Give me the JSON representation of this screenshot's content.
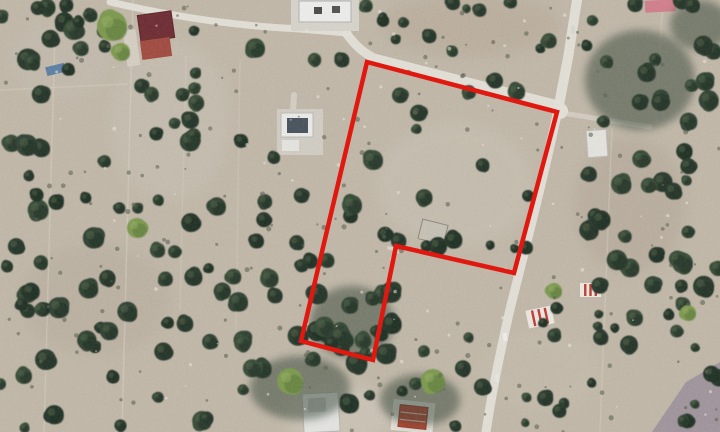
{
  "map": {
    "description": "Satellite aerial view of rural olive-grove parcels with a red land-parcel boundary overlay",
    "canvas": {
      "width": 720,
      "height": 432
    },
    "palette": {
      "soil_base": "#c4bbac",
      "soil_edge": "#b7ad9e",
      "road": "#e9e6de",
      "track": "#ded8ca",
      "tree_greens": [
        "#2e4130",
        "#27382a",
        "#364a36",
        "#203126"
      ],
      "tree_shadow": "#1c2a20",
      "tree_highlight": "#4d6344",
      "bright_green": "#7d9b4e",
      "bright_green_shade": "#5a7839",
      "purple_field": "#9e939d",
      "overlay_red": "#e0180f"
    },
    "overlay": {
      "label": "parcel-boundary-polygon",
      "color": "#e0180f",
      "stroke_width": 4.5,
      "points": [
        [
          367,
          62
        ],
        [
          557,
          112
        ],
        [
          514,
          273
        ],
        [
          396,
          246
        ],
        [
          373,
          360
        ],
        [
          301,
          341
        ],
        [
          329,
          222
        ]
      ]
    },
    "seed": 20240613,
    "patches": [
      {
        "cx": 455,
        "cy": 185,
        "rx": 78,
        "ry": 62,
        "fill": "#cdc6b8",
        "op": 0.55
      },
      {
        "cx": 340,
        "cy": 415,
        "rx": 55,
        "ry": 30,
        "fill": "#d8d2c5",
        "op": 0.5
      },
      {
        "cx": 630,
        "cy": 205,
        "rx": 55,
        "ry": 68,
        "fill": "#b4a698",
        "op": 0.45
      },
      {
        "cx": 95,
        "cy": 300,
        "rx": 75,
        "ry": 55,
        "fill": "#b6ab9c",
        "op": 0.35
      },
      {
        "cx": 170,
        "cy": 120,
        "rx": 60,
        "ry": 80,
        "fill": "#cfc8bb",
        "op": 0.4
      },
      {
        "cx": 540,
        "cy": 370,
        "rx": 60,
        "ry": 40,
        "fill": "#cbc2b2",
        "op": 0.4
      },
      {
        "cx": 60,
        "cy": 60,
        "rx": 50,
        "ry": 40,
        "fill": "#c9c2b6",
        "op": 0.4
      },
      {
        "cx": 470,
        "cy": 25,
        "rx": 90,
        "ry": 32,
        "fill": "#b9ab9a",
        "op": 0.5
      }
    ],
    "purple_field_points": [
      [
        652,
        432
      ],
      [
        686,
        382
      ],
      [
        720,
        362
      ],
      [
        720,
        432
      ]
    ],
    "field_lines": [
      {
        "x1": 55,
        "y1": 32,
        "x2": 44,
        "y2": 432,
        "op": 0.45
      },
      {
        "x1": 133,
        "y1": 0,
        "x2": 122,
        "y2": 432,
        "op": 0.5
      },
      {
        "x1": 186,
        "y1": 55,
        "x2": 180,
        "y2": 310,
        "op": 0.3
      },
      {
        "x1": 0,
        "y1": 90,
        "x2": 128,
        "y2": 84,
        "op": 0.4
      },
      {
        "x1": 612,
        "y1": 128,
        "x2": 600,
        "y2": 432,
        "op": 0.4
      },
      {
        "x1": 663,
        "y1": 0,
        "x2": 656,
        "y2": 115,
        "op": 0.35
      },
      {
        "x1": 240,
        "y1": 60,
        "x2": 236,
        "y2": 330,
        "op": 0.3
      }
    ],
    "roads": [
      {
        "name": "top-road",
        "d": "M110,2 C170,16 235,26 300,29 L348,33",
        "w": 7,
        "op": 0.95
      },
      {
        "name": "parcel-north-road",
        "d": "M346,33 C355,45 362,52 374,58 L558,105",
        "w": 9,
        "op": 0.95
      },
      {
        "name": "main-road-north",
        "d": "M577,0 L568,58 L558,110",
        "w": 10,
        "op": 0.95
      },
      {
        "name": "main-road-south",
        "d": "M558,110 C542,185 522,262 511,305 C501,348 492,392 486,432",
        "w": 9,
        "op": 0.95
      },
      {
        "name": "east-track",
        "d": "M562,113 L650,127",
        "w": 5,
        "op": 0.5
      },
      {
        "name": "driveway",
        "d": "M294,95 L291,142",
        "w": 6,
        "op": 0.55
      }
    ],
    "vehicles": [
      {
        "x": 503,
        "y": 333,
        "w": 4,
        "h": 8,
        "rot": -8,
        "fill": "#f3f3f0"
      },
      {
        "x": 495,
        "y": 374,
        "w": 4,
        "h": 8,
        "rot": -6,
        "fill": "#eaeae6"
      },
      {
        "x": 571,
        "y": 26,
        "w": 4,
        "h": 8,
        "rot": -5,
        "fill": "#dcdcd8"
      }
    ],
    "buildings": [
      {
        "name": "farmhouse-courtyard",
        "x": 125,
        "y": 30,
        "w": 13,
        "h": 36,
        "rot": -8,
        "fill": "#d9d3c7"
      },
      {
        "name": "farmhouse-dark-red-roof",
        "x": 139,
        "y": 13,
        "w": 34,
        "h": 27,
        "rot": -8,
        "fill": "#6e2a31",
        "stroke": "#5a2027"
      },
      {
        "name": "farmhouse-red-roof-wing",
        "x": 141,
        "y": 39,
        "w": 30,
        "h": 19,
        "rot": -8,
        "fill": "#a34a3f"
      },
      {
        "name": "warehouse-pad",
        "x": 291,
        "y": 0,
        "w": 68,
        "h": 31,
        "rot": 0,
        "fill": "#dbd8d0"
      },
      {
        "name": "warehouse",
        "x": 299,
        "y": 1,
        "w": 52,
        "h": 21,
        "rot": 0,
        "fill": "#f1f2f2",
        "stroke": "#b5b5b3"
      },
      {
        "name": "warehouse-roof-unit-1",
        "x": 314,
        "y": 7,
        "w": 8,
        "h": 7,
        "rot": 0,
        "fill": "#4a4a48"
      },
      {
        "name": "warehouse-roof-unit-2",
        "x": 332,
        "y": 6,
        "w": 8,
        "h": 7,
        "rot": 0,
        "fill": "#54524e"
      },
      {
        "name": "poolhouse-pad",
        "x": 277,
        "y": 109,
        "w": 46,
        "h": 46,
        "rot": 0,
        "fill": "#d5d1c8"
      },
      {
        "name": "poolhouse",
        "x": 281,
        "y": 113,
        "w": 32,
        "h": 24,
        "rot": 0,
        "fill": "#eff0ee",
        "stroke": "#bdbdb9"
      },
      {
        "name": "pool",
        "x": 287,
        "y": 118,
        "w": 21,
        "h": 15,
        "rot": 0,
        "fill": "#47525e"
      },
      {
        "name": "poolhouse-annex",
        "x": 282,
        "y": 140,
        "w": 17,
        "h": 11,
        "rot": 0,
        "fill": "#e9e9e6"
      },
      {
        "name": "shed-in-parcel",
        "x": 420,
        "y": 222,
        "w": 26,
        "h": 20,
        "rot": 14,
        "fill": "#cac5b9",
        "stroke": "#8d887c"
      },
      {
        "name": "white-shed-east",
        "x": 587,
        "y": 130,
        "w": 20,
        "h": 27,
        "rot": -4,
        "fill": "#eae8e4",
        "stroke": "#c0beba"
      },
      {
        "name": "pink-roof-house",
        "x": 645,
        "y": 0,
        "w": 31,
        "h": 12,
        "rot": -3,
        "fill": "#d5808e"
      },
      {
        "name": "striped-ruin-north",
        "x": 580,
        "y": 283,
        "w": 21,
        "h": 14,
        "rot": 0,
        "fill": "#f2efe9",
        "stripes": {
          "dir": "v",
          "n": 3,
          "color": "#c23b30"
        }
      },
      {
        "name": "striped-ruin-south",
        "x": 527,
        "y": 308,
        "w": 26,
        "h": 18,
        "rot": -12,
        "fill": "#f0ece6",
        "stripes": {
          "dir": "v",
          "n": 3,
          "color": "#c23b30"
        }
      },
      {
        "name": "bottom-house",
        "x": 303,
        "y": 393,
        "w": 36,
        "h": 39,
        "rot": -3,
        "fill": "#e8e8e6",
        "stroke": "#b9b9b7"
      },
      {
        "name": "bottom-house-annex",
        "x": 308,
        "y": 398,
        "w": 18,
        "h": 14,
        "rot": -3,
        "fill": "#c8c8c6"
      },
      {
        "name": "orange-roof-house-pad",
        "x": 392,
        "y": 401,
        "w": 42,
        "h": 31,
        "rot": 6,
        "fill": "#e9e6df"
      },
      {
        "name": "orange-roof-house",
        "x": 399,
        "y": 406,
        "w": 28,
        "h": 22,
        "rot": 6,
        "fill": "#c14330",
        "stroke": "#9e3526",
        "stripes": {
          "dir": "h",
          "n": 2,
          "color": "#e2c4ba"
        }
      },
      {
        "name": "blue-container",
        "x": 46,
        "y": 65,
        "w": 19,
        "h": 9,
        "rot": -14,
        "fill": "#5d81a7"
      }
    ],
    "groves": [
      {
        "cx": 352,
        "cy": 322,
        "rx": 42,
        "ry": 36
      },
      {
        "cx": 300,
        "cy": 388,
        "rx": 50,
        "ry": 32
      },
      {
        "cx": 420,
        "cy": 400,
        "rx": 40,
        "ry": 26
      },
      {
        "cx": 640,
        "cy": 80,
        "rx": 55,
        "ry": 50
      },
      {
        "cx": 700,
        "cy": 25,
        "rx": 30,
        "ry": 25
      }
    ],
    "tree_regions": [
      {
        "x": 0,
        "y": 0,
        "w": 115,
        "h": 432,
        "count": 42,
        "rmin": 5,
        "rmax": 11
      },
      {
        "x": 100,
        "y": 28,
        "w": 140,
        "h": 404,
        "count": 36,
        "rmin": 5,
        "rmax": 10
      },
      {
        "x": 232,
        "y": 35,
        "w": 120,
        "h": 290,
        "count": 20,
        "rmin": 5,
        "rmax": 10
      },
      {
        "x": 238,
        "y": 325,
        "w": 245,
        "h": 107,
        "count": 26,
        "rmin": 5,
        "rmax": 11
      },
      {
        "x": 302,
        "y": 278,
        "w": 90,
        "h": 84,
        "count": 13,
        "rmin": 6,
        "rmax": 11
      },
      {
        "x": 358,
        "y": 0,
        "w": 205,
        "h": 52,
        "count": 13,
        "rmin": 4,
        "rmax": 8
      },
      {
        "x": 372,
        "y": 68,
        "w": 180,
        "h": 185,
        "count": 17,
        "rmin": 4,
        "rmax": 9
      },
      {
        "x": 578,
        "y": 0,
        "w": 142,
        "h": 290,
        "count": 46,
        "rmin": 5,
        "rmax": 11
      },
      {
        "x": 522,
        "y": 282,
        "w": 198,
        "h": 150,
        "count": 26,
        "rmin": 4,
        "rmax": 9
      },
      {
        "x": 60,
        "y": 0,
        "w": 60,
        "h": 30,
        "count": 5,
        "rmin": 4,
        "rmax": 8
      }
    ],
    "avoid_boxes": [
      [
        123,
        6,
        58,
        64
      ],
      [
        288,
        0,
        74,
        34
      ],
      [
        274,
        106,
        52,
        52
      ],
      [
        576,
        126,
        36,
        34
      ],
      [
        390,
        397,
        50,
        38
      ],
      [
        298,
        388,
        46,
        46
      ],
      [
        415,
        216,
        38,
        30
      ],
      [
        100,
        0,
        250,
        26
      ]
    ],
    "accent_trees": [
      {
        "x": 438,
        "y": 246,
        "r": 9
      },
      {
        "x": 373,
        "y": 160,
        "r": 10
      },
      {
        "x": 352,
        "y": 205,
        "r": 10
      }
    ],
    "feature_green_trees": [
      {
        "x": 112,
        "y": 26,
        "r": 15
      },
      {
        "x": 121,
        "y": 52,
        "r": 9
      },
      {
        "x": 137,
        "y": 228,
        "r": 10
      },
      {
        "x": 290,
        "y": 381,
        "r": 13
      },
      {
        "x": 433,
        "y": 381,
        "r": 12
      },
      {
        "x": 554,
        "y": 291,
        "r": 8
      },
      {
        "x": 688,
        "y": 313,
        "r": 8
      }
    ],
    "shrubs": {
      "count": 170,
      "rmin": 1,
      "rmax": 2.6,
      "color": "#5f6353",
      "op": 0.6
    },
    "stones": {
      "count": 70,
      "rmin": 0.8,
      "rmax": 2,
      "color": "#efece4",
      "op": 0.55
    }
  }
}
